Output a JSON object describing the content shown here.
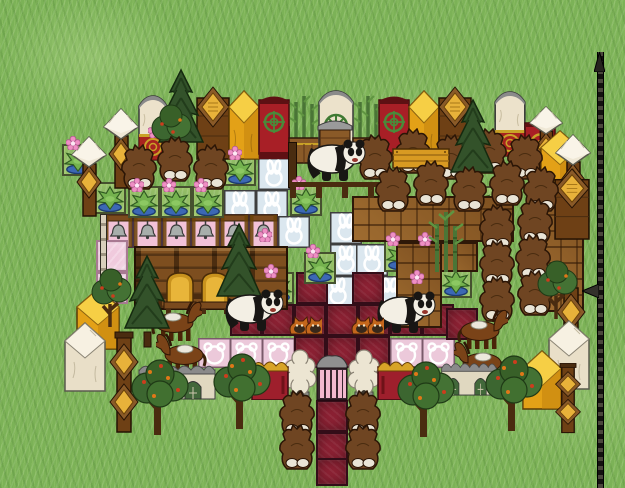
{
  "meta": {
    "width": 625,
    "height": 488,
    "view": "top-down-tile-garden"
  },
  "scene": {
    "colors": {
      "grass": "#7cb257",
      "redTile": "#8c2133",
      "pinkTile": "#f0cadd",
      "blueTile": "#dbe7ef",
      "gold": "#e8a61b",
      "wood": "#8f5c26",
      "cream": "#ece2cb",
      "bearBrown": "#6f4522",
      "medallionGreen": "#4a8a3a"
    },
    "tiles": [
      {
        "t": "bunny",
        "x": 258,
        "y": 126
      },
      {
        "t": "bunny",
        "x": 258,
        "y": 158
      },
      {
        "t": "bunny",
        "x": 224,
        "y": 190
      },
      {
        "t": "bunny",
        "x": 256,
        "y": 190
      },
      {
        "t": "bunny",
        "x": 278,
        "y": 216
      },
      {
        "t": "bunny",
        "x": 330,
        "y": 212
      },
      {
        "t": "bunny",
        "x": 330,
        "y": 244
      },
      {
        "t": "bunny",
        "x": 356,
        "y": 244
      },
      {
        "t": "bunny",
        "x": 322,
        "y": 276
      },
      {
        "t": "bunny",
        "x": 374,
        "y": 276
      },
      {
        "t": "bell",
        "x": 104,
        "y": 214
      },
      {
        "t": "bell",
        "x": 133,
        "y": 214
      },
      {
        "t": "bell",
        "x": 162,
        "y": 214
      },
      {
        "t": "bell",
        "x": 191,
        "y": 214
      },
      {
        "t": "bell",
        "x": 220,
        "y": 214
      },
      {
        "t": "bell",
        "x": 249,
        "y": 214
      },
      {
        "t": "teddy",
        "x": 198,
        "y": 338
      },
      {
        "t": "teddy",
        "x": 230,
        "y": 338
      },
      {
        "t": "teddy",
        "x": 262,
        "y": 338
      },
      {
        "t": "teddy",
        "x": 390,
        "y": 338
      },
      {
        "t": "teddy",
        "x": 422,
        "y": 338
      },
      {
        "t": "pink",
        "x": 96,
        "y": 240
      },
      {
        "t": "pink",
        "x": 96,
        "y": 272
      },
      {
        "t": "pink",
        "x": 230,
        "y": 272
      },
      {
        "t": "red",
        "x": 296,
        "y": 272
      },
      {
        "t": "red",
        "x": 352,
        "y": 272
      },
      {
        "t": "red",
        "x": 404,
        "y": 274
      },
      {
        "t": "red",
        "x": 230,
        "y": 304
      },
      {
        "t": "red",
        "x": 262,
        "y": 304
      },
      {
        "t": "red",
        "x": 294,
        "y": 304
      },
      {
        "t": "red",
        "x": 326,
        "y": 304
      },
      {
        "t": "red",
        "x": 358,
        "y": 304
      },
      {
        "t": "red",
        "x": 390,
        "y": 304
      },
      {
        "t": "red",
        "x": 422,
        "y": 304
      },
      {
        "t": "red",
        "x": 446,
        "y": 308
      },
      {
        "t": "red",
        "x": 294,
        "y": 336
      },
      {
        "t": "red",
        "x": 326,
        "y": 336
      },
      {
        "t": "red",
        "x": 358,
        "y": 336
      },
      {
        "t": "red",
        "x": 316,
        "y": 400
      },
      {
        "t": "red",
        "x": 316,
        "y": 432
      },
      {
        "t": "red",
        "x": 316,
        "y": 458,
        "h": 28
      },
      {
        "t": "plantbed",
        "x": 62,
        "y": 144
      },
      {
        "t": "plantbed",
        "x": 94,
        "y": 182
      },
      {
        "t": "plantbed",
        "x": 224,
        "y": 154
      },
      {
        "t": "plantbed",
        "x": 128,
        "y": 186
      },
      {
        "t": "plantbed",
        "x": 160,
        "y": 186
      },
      {
        "t": "plantbed",
        "x": 192,
        "y": 186
      },
      {
        "t": "plantbed",
        "x": 290,
        "y": 184
      },
      {
        "t": "plantbed",
        "x": 462,
        "y": 186
      },
      {
        "t": "plantbed",
        "x": 304,
        "y": 252
      },
      {
        "t": "plantbed",
        "x": 262,
        "y": 272
      },
      {
        "t": "plantbed",
        "x": 384,
        "y": 240
      },
      {
        "t": "plantbed",
        "x": 416,
        "y": 240
      },
      {
        "t": "plantbed",
        "x": 440,
        "y": 266
      },
      {
        "t": "plantbed",
        "x": 408,
        "y": 278
      },
      {
        "t": "plantbed",
        "x": 528,
        "y": 278
      }
    ],
    "floors": [
      {
        "t": "parquet",
        "x": 352,
        "y": 196,
        "w": 162,
        "h": 46
      },
      {
        "t": "parquet",
        "x": 396,
        "y": 242,
        "w": 46,
        "h": 86
      },
      {
        "t": "parquet",
        "x": 440,
        "y": 242,
        "w": 38,
        "h": 30
      },
      {
        "t": "parquet",
        "x": 544,
        "y": 190,
        "w": 40,
        "h": 122
      },
      {
        "t": "counter",
        "x": 134,
        "y": 246,
        "w": 154,
        "h": 64
      }
    ],
    "top_wall": [
      {
        "t": "cream_gold",
        "x": 136,
        "y": 94
      },
      {
        "t": "wood_diamond",
        "x": 196,
        "y": 86
      },
      {
        "t": "gold_block",
        "x": 228,
        "y": 90
      },
      {
        "t": "red_green",
        "x": 258,
        "y": 94
      },
      {
        "t": "bamboo_box",
        "x": 288,
        "y": 92
      },
      {
        "t": "cream_green",
        "x": 316,
        "y": 88
      },
      {
        "t": "bamboo_box",
        "x": 352,
        "y": 92
      },
      {
        "t": "red_green",
        "x": 378,
        "y": 94
      },
      {
        "t": "gold_block",
        "x": 408,
        "y": 90
      },
      {
        "t": "wood_diamond",
        "x": 438,
        "y": 86
      },
      {
        "t": "cream_gold",
        "x": 492,
        "y": 90,
        "w": 36
      },
      {
        "t": "red_gold",
        "x": 524,
        "y": 118
      }
    ],
    "left_wall": [
      {
        "t": "white_post",
        "x": 102,
        "y": 108
      },
      {
        "t": "white_post",
        "x": 70,
        "y": 136
      },
      {
        "t": "pole",
        "x": 100,
        "y": 214,
        "w": 7,
        "h": 88
      },
      {
        "t": "gold_block_sm",
        "x": 76,
        "y": 288
      },
      {
        "t": "white_block",
        "x": 64,
        "y": 322
      },
      {
        "t": "totem_gold",
        "x": 106,
        "y": 330
      }
    ],
    "right_wall": [
      {
        "t": "white_post",
        "x": 528,
        "y": 106,
        "w": 36,
        "h": 74
      },
      {
        "t": "gold_block_sm",
        "x": 540,
        "y": 130,
        "w": 40,
        "h": 58
      },
      {
        "t": "white_post",
        "x": 554,
        "y": 134
      },
      {
        "t": "wood_diamond",
        "x": 554,
        "y": 168,
        "w": 36,
        "h": 72
      },
      {
        "t": "wood_post_gold",
        "x": 552,
        "y": 286
      },
      {
        "t": "white_block",
        "x": 548,
        "y": 320
      },
      {
        "t": "gold_block_sm",
        "x": 522,
        "y": 350,
        "w": 40,
        "h": 60
      },
      {
        "t": "totem_gold",
        "x": 552,
        "y": 362,
        "w": 32,
        "h": 72
      }
    ],
    "sprites": [
      {
        "t": "bear",
        "x": 120,
        "y": 144
      },
      {
        "t": "bear",
        "x": 156,
        "y": 136
      },
      {
        "t": "bear",
        "x": 192,
        "y": 144
      },
      {
        "t": "bear",
        "x": 356,
        "y": 134
      },
      {
        "t": "bear",
        "x": 394,
        "y": 128
      },
      {
        "t": "bear",
        "x": 432,
        "y": 134
      },
      {
        "t": "bear",
        "x": 470,
        "y": 128
      },
      {
        "t": "bear",
        "x": 506,
        "y": 134
      },
      {
        "t": "bear",
        "x": 374,
        "y": 166
      },
      {
        "t": "bear",
        "x": 412,
        "y": 160
      },
      {
        "t": "bear",
        "x": 450,
        "y": 166
      },
      {
        "t": "bear",
        "x": 488,
        "y": 160
      },
      {
        "t": "bear",
        "x": 522,
        "y": 166
      },
      {
        "t": "bear",
        "x": 516,
        "y": 198
      },
      {
        "t": "bear",
        "x": 478,
        "y": 204
      },
      {
        "t": "bear",
        "x": 514,
        "y": 234
      },
      {
        "t": "bear",
        "x": 478,
        "y": 240
      },
      {
        "t": "bear",
        "x": 516,
        "y": 270
      },
      {
        "t": "bear",
        "x": 478,
        "y": 276
      },
      {
        "t": "bear",
        "x": 278,
        "y": 390
      },
      {
        "t": "bear",
        "x": 278,
        "y": 424
      },
      {
        "t": "bear",
        "x": 344,
        "y": 390
      },
      {
        "t": "bear",
        "x": 344,
        "y": 424
      },
      {
        "t": "panda",
        "x": 302,
        "y": 138
      },
      {
        "t": "panda",
        "x": 220,
        "y": 288
      },
      {
        "t": "panda",
        "x": 372,
        "y": 290
      },
      {
        "t": "horse",
        "x": 148,
        "y": 298
      },
      {
        "t": "horse",
        "x": 156,
        "y": 330,
        "flip": true
      },
      {
        "t": "horse",
        "x": 454,
        "y": 306
      },
      {
        "t": "horse",
        "x": 454,
        "y": 338,
        "flip": true
      },
      {
        "t": "foxpair",
        "x": 288,
        "y": 312
      },
      {
        "t": "foxpair",
        "x": 350,
        "y": 312
      },
      {
        "t": "sheep",
        "x": 283,
        "y": 348
      },
      {
        "t": "sheep",
        "x": 347,
        "y": 348
      },
      {
        "t": "chair",
        "x": 163,
        "y": 268
      },
      {
        "t": "chair",
        "x": 198,
        "y": 268
      },
      {
        "t": "sign",
        "x": 392,
        "y": 146
      },
      {
        "t": "hutch",
        "x": 316,
        "y": 116
      },
      {
        "t": "gate",
        "x": 315,
        "y": 352
      },
      {
        "t": "red_arch",
        "x": 251,
        "y": 356
      },
      {
        "t": "red_arch",
        "x": 377,
        "y": 356
      },
      {
        "t": "stone_arch2",
        "x": 138,
        "y": 360
      },
      {
        "t": "stone_arch2",
        "x": 441,
        "y": 358,
        "w": 56,
        "h": 38
      },
      {
        "t": "fence_h",
        "x": 290,
        "y": 182,
        "w": 104,
        "h": 16
      },
      {
        "t": "fence_h",
        "x": 156,
        "y": 294,
        "w": 62,
        "h": 14
      },
      {
        "t": "fence_v",
        "x": 288,
        "y": 142,
        "w": 9,
        "h": 46
      },
      {
        "t": "pine",
        "x": 156,
        "y": 68
      },
      {
        "t": "pine",
        "x": 448,
        "y": 98
      },
      {
        "t": "pine",
        "x": 122,
        "y": 254
      },
      {
        "t": "pine",
        "x": 214,
        "y": 222
      },
      {
        "t": "apple",
        "x": 128,
        "y": 352
      },
      {
        "t": "apple",
        "x": 210,
        "y": 346
      },
      {
        "t": "apple",
        "x": 394,
        "y": 354
      },
      {
        "t": "apple",
        "x": 482,
        "y": 348
      },
      {
        "t": "sapling",
        "x": 88,
        "y": 266
      },
      {
        "t": "sapling",
        "x": 148,
        "y": 102
      },
      {
        "t": "sapling",
        "x": 534,
        "y": 258
      },
      {
        "t": "bamboo_bush",
        "x": 426,
        "y": 206
      },
      {
        "t": "flower",
        "x": 66,
        "y": 136
      },
      {
        "t": "flower",
        "x": 228,
        "y": 146
      },
      {
        "t": "flower",
        "x": 130,
        "y": 178
      },
      {
        "t": "flower",
        "x": 162,
        "y": 178
      },
      {
        "t": "flower",
        "x": 194,
        "y": 178
      },
      {
        "t": "flower",
        "x": 292,
        "y": 176
      },
      {
        "t": "flower",
        "x": 464,
        "y": 178
      },
      {
        "t": "flower",
        "x": 306,
        "y": 244
      },
      {
        "t": "flower",
        "x": 264,
        "y": 264
      },
      {
        "t": "flower",
        "x": 386,
        "y": 232
      },
      {
        "t": "flower",
        "x": 418,
        "y": 232
      },
      {
        "t": "flower",
        "x": 410,
        "y": 270
      },
      {
        "t": "flower",
        "x": 148,
        "y": 124
      },
      {
        "t": "flower",
        "x": 258,
        "y": 228
      },
      {
        "t": "flower",
        "x": 532,
        "y": 292
      }
    ],
    "spear": {
      "x": 597,
      "y": 52,
      "h": 436,
      "blade_y": 284
    }
  }
}
